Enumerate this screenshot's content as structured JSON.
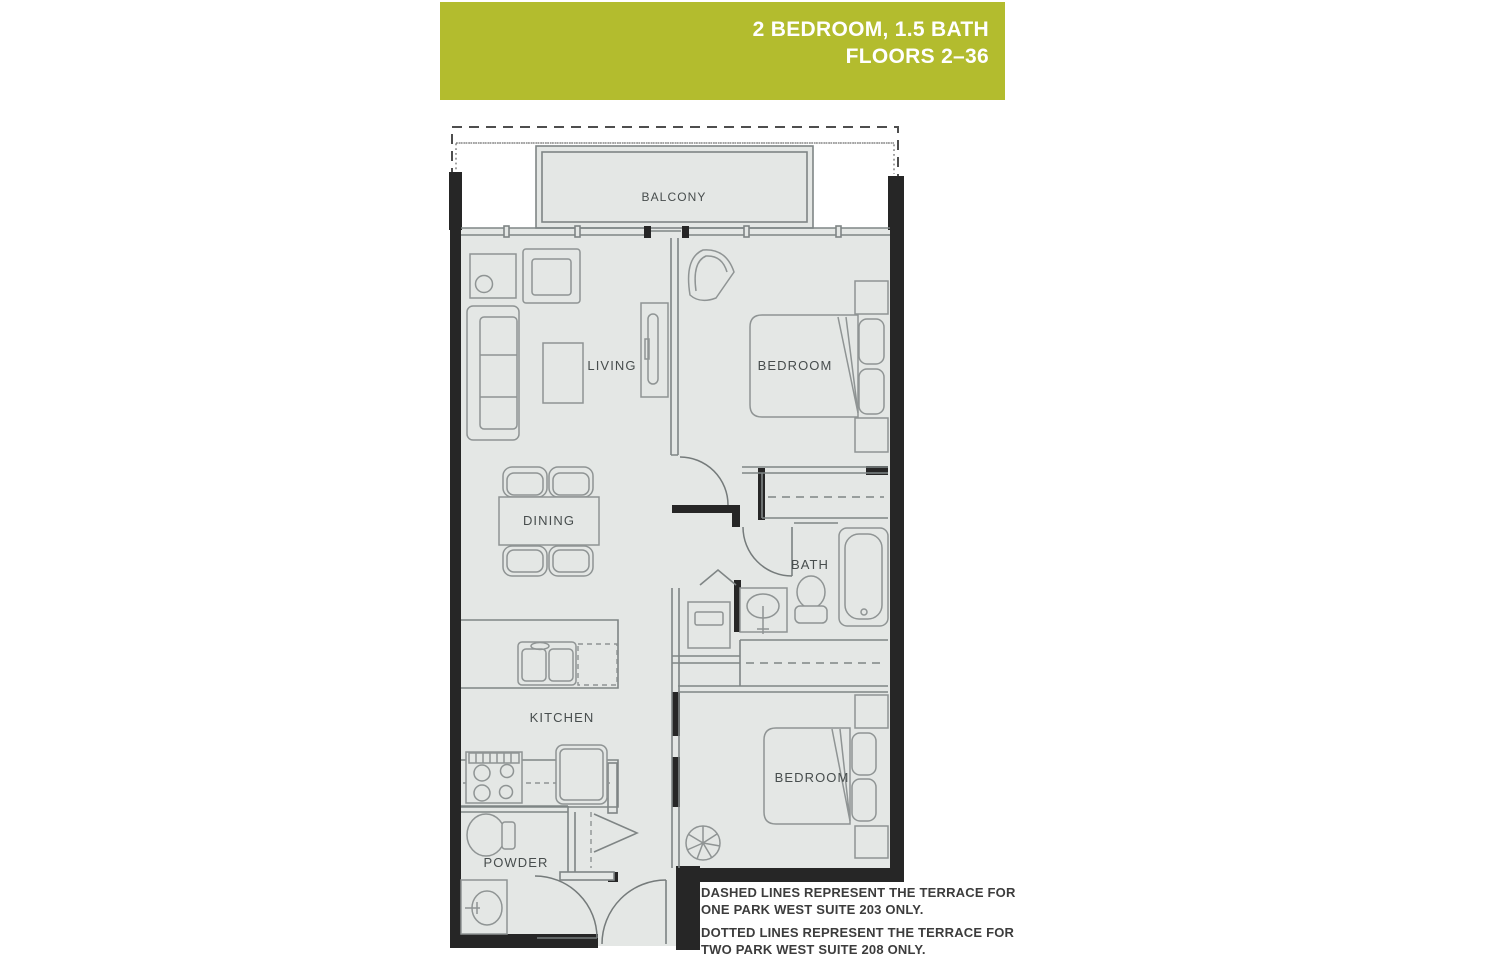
{
  "header": {
    "line1": "2 BEDROOM, 1.5 BATH",
    "line2": "FLOORS 2–36"
  },
  "rooms": {
    "balcony": "BALCONY",
    "living": "LIVING",
    "bedroom_upper": "BEDROOM",
    "dining": "DINING",
    "bath": "BATH",
    "kitchen": "KITCHEN",
    "bedroom_lower": "BEDROOM",
    "powder": "POWDER"
  },
  "notes": {
    "dashed_l1": "DASHED LINES REPRESENT THE TERRACE FOR",
    "dashed_l2": "ONE PARK WEST SUITE 203 ONLY.",
    "dotted_l1": "DOTTED LINES REPRESENT THE TERRACE FOR",
    "dotted_l2": "TWO PARK WEST SUITE 208 ONLY."
  },
  "colors": {
    "header_bg": "#b3bc2e",
    "header_text": "#ffffff",
    "floor_fill": "#e4e7e5",
    "wall": "#262626",
    "line": "#8f9494",
    "label": "#474d4d"
  }
}
